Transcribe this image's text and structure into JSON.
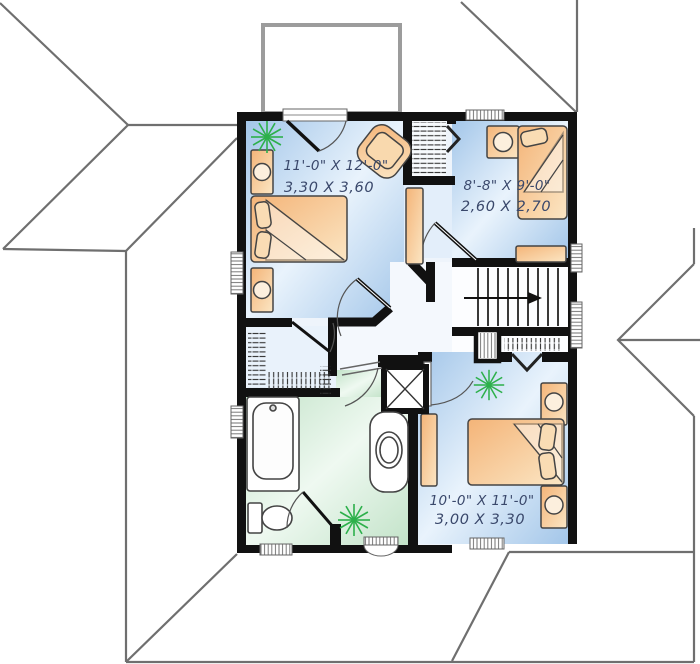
{
  "drawing": {
    "type": "floor-plan",
    "rooms": [
      {
        "id": "bedroom-1",
        "dimensions_imperial": "11'-0\" X 12'-0\"",
        "dimensions_metric": "3,30 X 3,60"
      },
      {
        "id": "bedroom-2",
        "dimensions_imperial": "8'-8\" X 9'-0\"",
        "dimensions_metric": "2,60 X 2,70"
      },
      {
        "id": "bedroom-3",
        "dimensions_imperial": "10'-0\" X 11'-0\"",
        "dimensions_metric": "3,00 X 3,30"
      }
    ],
    "stairs": {
      "direction_arrow": "right"
    },
    "fixtures": [
      "double-bed",
      "single-bed",
      "nightstand",
      "armchair",
      "dresser",
      "bathtub",
      "toilet",
      "vanity-sink",
      "linen-closet",
      "walk-in-closet",
      "stairs",
      "plant"
    ],
    "colors": {
      "wall": "#111111",
      "roof_line": "#6f6f6f",
      "floor_blue": "#a3c6e9",
      "floor_green": "#c3e3c9",
      "furniture_tan": "#f4b478",
      "plant_green": "#2db04b",
      "dimension_text": "#3a486b"
    }
  }
}
